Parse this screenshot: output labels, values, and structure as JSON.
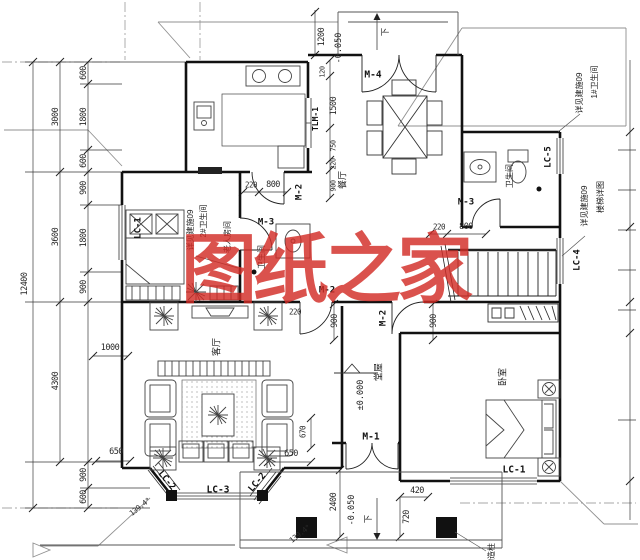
{
  "watermark": {
    "text": "图纸之家",
    "color": "#d22c26"
  },
  "line_colors": {
    "walls": "#111111",
    "thin": "#333333",
    "roof": "#909090"
  },
  "labels": [
    {
      "t": "M-4",
      "x": 373,
      "y": 75,
      "r": 0,
      "s": 9.5,
      "k": "code"
    },
    {
      "t": "TLM-1",
      "x": 316,
      "y": 119,
      "r": -90,
      "s": 8,
      "k": "code"
    },
    {
      "t": "M-2",
      "x": 300,
      "y": 192,
      "r": -90,
      "s": 9,
      "k": "code"
    },
    {
      "t": "M-3",
      "x": 266,
      "y": 223,
      "r": 0,
      "s": 9,
      "k": "code"
    },
    {
      "t": "M-3",
      "x": 466,
      "y": 203,
      "r": 0,
      "s": 9,
      "k": "code"
    },
    {
      "t": "M-2",
      "x": 327,
      "y": 291,
      "r": 0,
      "s": 9,
      "k": "code"
    },
    {
      "t": "M-2",
      "x": 384,
      "y": 318,
      "r": -90,
      "s": 9,
      "k": "code"
    },
    {
      "t": "M-1",
      "x": 371,
      "y": 437,
      "r": 0,
      "s": 9.5,
      "k": "code"
    },
    {
      "t": "LC-1",
      "x": 139,
      "y": 228,
      "r": -90,
      "s": 9,
      "k": "code"
    },
    {
      "t": "LC-1",
      "x": 514,
      "y": 470,
      "r": 0,
      "s": 9.5,
      "k": "code"
    },
    {
      "t": "LC-2",
      "x": 166,
      "y": 481,
      "r": 50,
      "s": 9,
      "k": "code"
    },
    {
      "t": "LC-2",
      "x": 258,
      "y": 483,
      "r": -50,
      "s": 9,
      "k": "code"
    },
    {
      "t": "LC-3",
      "x": 218,
      "y": 490,
      "r": 0,
      "s": 9.5,
      "k": "code"
    },
    {
      "t": "LC-4",
      "x": 578,
      "y": 260,
      "r": -90,
      "s": 9,
      "k": "code"
    },
    {
      "t": "LC-5",
      "x": 549,
      "y": 157,
      "r": -90,
      "s": 9,
      "k": "code"
    },
    {
      "t": "餐厅",
      "x": 343,
      "y": 180,
      "r": -90,
      "s": 9,
      "k": "room"
    },
    {
      "t": "卫生间",
      "x": 510,
      "y": 176,
      "r": -90,
      "s": 8,
      "k": "room"
    },
    {
      "t": "老人房间",
      "x": 228,
      "y": 237,
      "r": -90,
      "s": 8,
      "k": "room"
    },
    {
      "t": "卫生间",
      "x": 262,
      "y": 257,
      "r": -90,
      "s": 8,
      "k": "room"
    },
    {
      "t": "客厅",
      "x": 217,
      "y": 347,
      "r": -90,
      "s": 9,
      "k": "room"
    },
    {
      "t": "堂屋",
      "x": 379,
      "y": 372,
      "r": -90,
      "s": 9,
      "k": "room"
    },
    {
      "t": "卧室",
      "x": 503,
      "y": 377,
      "r": -90,
      "s": 9,
      "k": "room"
    },
    {
      "t": "1#卫生间",
      "x": 595,
      "y": 82,
      "r": -90,
      "s": 8,
      "k": "ann"
    },
    {
      "t": "详见建施09",
      "x": 580,
      "y": 93,
      "r": -90,
      "s": 8,
      "k": "ann"
    },
    {
      "t": "楼梯详图",
      "x": 601,
      "y": 197,
      "r": -90,
      "s": 8,
      "k": "ann"
    },
    {
      "t": "详见建施09",
      "x": 585,
      "y": 206,
      "r": -90,
      "s": 8,
      "k": "ann"
    },
    {
      "t": "2#卫生间",
      "x": 204,
      "y": 221,
      "r": -90,
      "s": 8,
      "k": "ann"
    },
    {
      "t": "详见建施09",
      "x": 191,
      "y": 230,
      "r": -90,
      "s": 8,
      "k": "ann"
    },
    {
      "t": "构造柱",
      "x": 492,
      "y": 555,
      "r": -90,
      "s": 8,
      "k": "ann"
    },
    {
      "t": "±0.000",
      "x": 361,
      "y": 395,
      "r": -90,
      "s": 8.5,
      "k": "elev"
    },
    {
      "t": "-0.050",
      "x": 339,
      "y": 48,
      "r": -90,
      "s": 8.5,
      "k": "elev"
    },
    {
      "t": "-0.050",
      "x": 352,
      "y": 510,
      "r": -90,
      "s": 8.5,
      "k": "elev"
    },
    {
      "t": "下",
      "x": 386,
      "y": 32,
      "r": -90,
      "s": 8.5,
      "k": "elev"
    },
    {
      "t": "下",
      "x": 369,
      "y": 519,
      "r": -90,
      "s": 8.5,
      "k": "elev"
    },
    {
      "t": "600",
      "x": 84,
      "y": 73,
      "r": -90,
      "k": "dim"
    },
    {
      "t": "1800",
      "x": 84,
      "y": 117,
      "r": -90,
      "k": "dim"
    },
    {
      "t": "600",
      "x": 84,
      "y": 161,
      "r": -90,
      "k": "dim"
    },
    {
      "t": "900",
      "x": 84,
      "y": 188,
      "r": -90,
      "k": "dim"
    },
    {
      "t": "1800",
      "x": 84,
      "y": 238,
      "r": -90,
      "k": "dim"
    },
    {
      "t": "900",
      "x": 84,
      "y": 287,
      "r": -90,
      "k": "dim"
    },
    {
      "t": "900",
      "x": 84,
      "y": 475,
      "r": -90,
      "k": "dim"
    },
    {
      "t": "600",
      "x": 84,
      "y": 497,
      "r": -90,
      "k": "dim"
    },
    {
      "t": "3000",
      "x": 56,
      "y": 117,
      "r": -90,
      "k": "dim"
    },
    {
      "t": "3600",
      "x": 56,
      "y": 237,
      "r": -90,
      "k": "dim"
    },
    {
      "t": "4300",
      "x": 56,
      "y": 381,
      "r": -90,
      "k": "dim"
    },
    {
      "t": "12400",
      "x": 25,
      "y": 284,
      "r": -90,
      "k": "dim"
    },
    {
      "t": "1200",
      "x": 322,
      "y": 37,
      "r": -90,
      "k": "dim"
    },
    {
      "t": "120",
      "x": 323,
      "y": 72,
      "r": -90,
      "s": 7,
      "k": "dim"
    },
    {
      "t": "1500",
      "x": 334,
      "y": 106,
      "r": -90,
      "k": "dim"
    },
    {
      "t": "750",
      "x": 334,
      "y": 146,
      "r": -90,
      "s": 7,
      "k": "dim"
    },
    {
      "t": "220",
      "x": 334,
      "y": 164,
      "r": -90,
      "s": 7,
      "k": "dim"
    },
    {
      "t": "900",
      "x": 334,
      "y": 186,
      "r": -90,
      "s": 7,
      "k": "dim"
    },
    {
      "t": "220",
      "x": 251,
      "y": 185,
      "r": 0,
      "s": 7.5,
      "k": "dim"
    },
    {
      "t": "800",
      "x": 273,
      "y": 185,
      "r": 0,
      "k": "dim"
    },
    {
      "t": "220",
      "x": 439,
      "y": 227,
      "r": 0,
      "s": 7.5,
      "k": "dim"
    },
    {
      "t": "800",
      "x": 466,
      "y": 227,
      "r": 0,
      "k": "dim"
    },
    {
      "t": "900",
      "x": 335,
      "y": 321,
      "r": -90,
      "k": "dim"
    },
    {
      "t": "900",
      "x": 434,
      "y": 321,
      "r": -90,
      "k": "dim"
    },
    {
      "t": "220",
      "x": 295,
      "y": 312,
      "r": 0,
      "s": 7.5,
      "k": "dim"
    },
    {
      "t": "1000",
      "x": 110,
      "y": 348,
      "r": 0,
      "k": "dim"
    },
    {
      "t": "670",
      "x": 303,
      "y": 432,
      "r": -90,
      "s": 7.5,
      "k": "dim"
    },
    {
      "t": "650",
      "x": 116,
      "y": 452,
      "r": 0,
      "k": "dim"
    },
    {
      "t": "650",
      "x": 291,
      "y": 454,
      "r": 0,
      "k": "dim"
    },
    {
      "t": "420",
      "x": 417,
      "y": 491,
      "r": 0,
      "k": "dim"
    },
    {
      "t": "720",
      "x": 407,
      "y": 517,
      "r": -90,
      "k": "dim"
    },
    {
      "t": "2400",
      "x": 334,
      "y": 502,
      "r": -90,
      "k": "dim"
    },
    {
      "t": "139.4°",
      "x": 140,
      "y": 507,
      "r": -38,
      "s": 7.5,
      "k": "dim"
    },
    {
      "t": "139.4°",
      "x": 300,
      "y": 534,
      "r": -38,
      "s": 7.5,
      "k": "dim"
    }
  ]
}
